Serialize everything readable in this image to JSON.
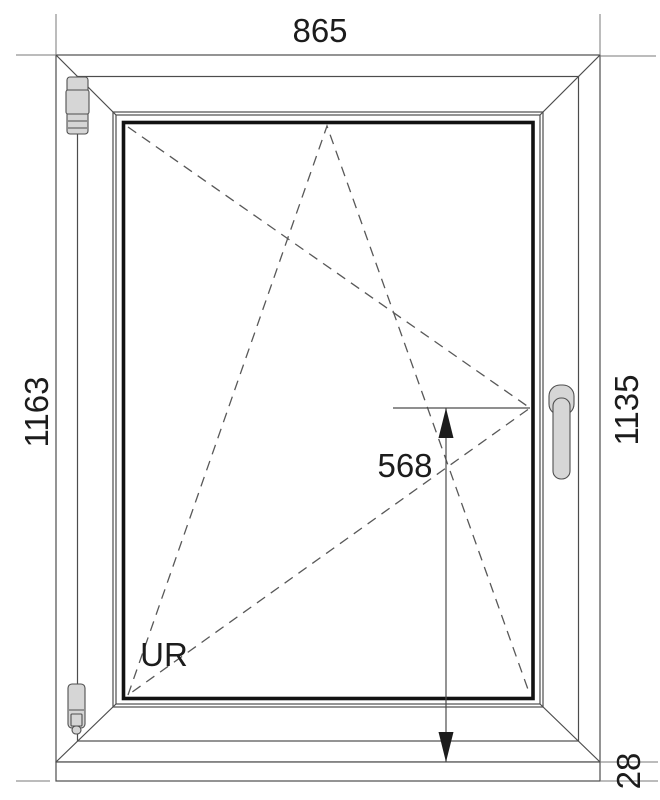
{
  "drawing": {
    "title": "tilt-and-turn window technical drawing",
    "labels": {
      "width": "865",
      "height_total": "1163",
      "height_sash_side": "1135",
      "sill_extension": "28",
      "handle_height": "568",
      "opening_code": "UR"
    },
    "colors": {
      "bg": "#ffffff",
      "outline": "#4c4c4c",
      "glass_border": "#121212",
      "ext": "#7a7a7a",
      "dash": "#585858",
      "text": "#1c1c1c",
      "hw_fill": "#d6d6d6",
      "hw_stroke": "#4f4f4f"
    }
  }
}
